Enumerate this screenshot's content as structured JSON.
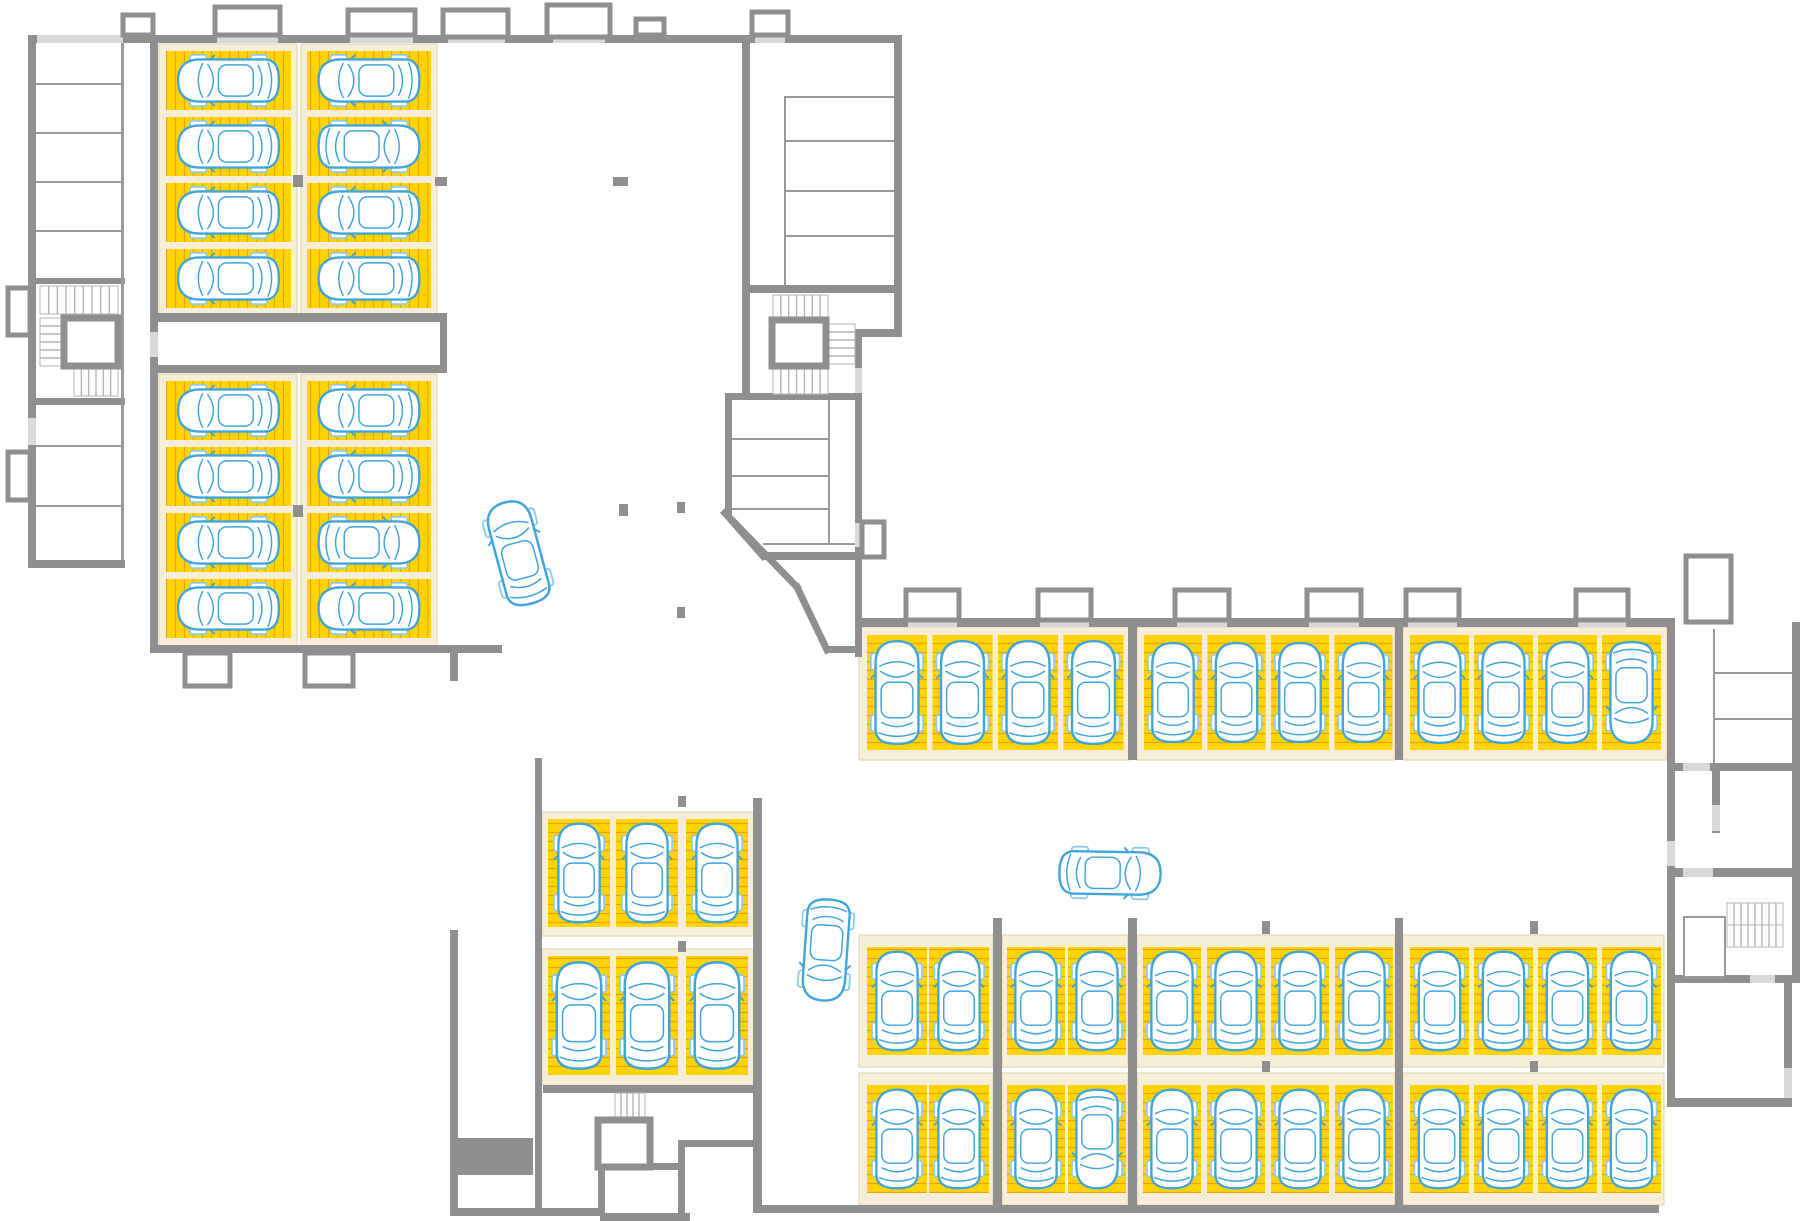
{
  "canvas": {
    "width": 1800,
    "height": 1221
  },
  "drawing": {
    "type": "parking-garage-floor-plan",
    "visible_text": [],
    "summary": {
      "parking_stalls": 58,
      "parked_cars": 58,
      "moving_cars": 3,
      "stair_cores": 4,
      "elevators": 3
    }
  },
  "palette": {
    "background": "#FFFFFF",
    "stall_yellow": "#FFD400",
    "stall_hatch": "#EFA200",
    "stall_apron_cream": "#F6EED8",
    "apron_outline": "#DDD3AF",
    "wall_gray": "#8F8F8F",
    "wall_light_door": "#D9D9D9",
    "thin_line_gray": "#9A9A9A",
    "stair_line_gray": "#B5B5B5",
    "car_outline_blue": "#3FA5DC",
    "car_wheel_blue": "#8FCBEA"
  },
  "stall_blocks": [
    {
      "name": "block-a-col-1",
      "cream": [
        159,
        44,
        138,
        272
      ],
      "orient": "h",
      "x0": 166,
      "y0": 51,
      "dx": 0,
      "dy": 66,
      "w": 125,
      "h": 59,
      "n": 4,
      "flips": []
    },
    {
      "name": "block-a-col-2",
      "cream": [
        301,
        44,
        136,
        272
      ],
      "orient": "h",
      "x0": 307,
      "y0": 51,
      "dx": 0,
      "dy": 66,
      "w": 124,
      "h": 59,
      "n": 4,
      "flips": [
        1
      ]
    },
    {
      "name": "block-b-col-1",
      "cream": [
        159,
        374,
        138,
        273
      ],
      "orient": "h",
      "x0": 166,
      "y0": 381,
      "dx": 0,
      "dy": 66,
      "w": 125,
      "h": 59,
      "n": 4,
      "flips": []
    },
    {
      "name": "block-b-col-2",
      "cream": [
        301,
        374,
        136,
        273
      ],
      "orient": "h",
      "x0": 307,
      "y0": 381,
      "dx": 0,
      "dy": 66,
      "w": 124,
      "h": 59,
      "n": 4,
      "flips": [
        2
      ]
    },
    {
      "name": "center-block-row-1",
      "cream": [
        542,
        812,
        214,
        124
      ],
      "orient": "v",
      "xs": [
        548,
        616,
        686
      ],
      "y0": 819,
      "w": 62,
      "h": 108,
      "n": 3,
      "flips": []
    },
    {
      "name": "center-block-row-2",
      "cream": [
        542,
        949,
        214,
        136
      ],
      "orient": "v",
      "xs": [
        548,
        616,
        686
      ],
      "y0": 956,
      "w": 62,
      "h": 119,
      "n": 3,
      "flips": []
    },
    {
      "name": "north-east-row-group-1",
      "cream": [
        859,
        627,
        271,
        133
      ],
      "orient": "v",
      "x0": 867,
      "y0": 635,
      "dx": 65.5,
      "dy": 0,
      "w": 60,
      "h": 115,
      "n": 4,
      "flips": []
    },
    {
      "name": "north-east-row-group-2",
      "cream": [
        1137,
        627,
        258,
        133
      ],
      "orient": "v",
      "x0": 1144,
      "y0": 635,
      "dx": 63.5,
      "dy": 0,
      "w": 58,
      "h": 115,
      "n": 4,
      "flips": []
    },
    {
      "name": "north-east-row-group-3",
      "cream": [
        1403,
        627,
        264,
        133
      ],
      "orient": "v",
      "x0": 1410,
      "y0": 635,
      "dx": 64,
      "dy": 0,
      "w": 59,
      "h": 115,
      "n": 4,
      "flips": [
        3
      ]
    },
    {
      "name": "south-row-a-group-1",
      "cream": [
        859,
        935,
        134,
        132
      ],
      "orient": "v",
      "x0": 867,
      "y0": 947,
      "dx": 62,
      "dy": 0,
      "w": 60,
      "h": 108,
      "n": 2,
      "flips": []
    },
    {
      "name": "south-row-a-group-2",
      "cream": [
        1002,
        935,
        126,
        132
      ],
      "orient": "v",
      "x0": 1007,
      "y0": 947,
      "dx": 61,
      "dy": 0,
      "w": 58,
      "h": 108,
      "n": 2,
      "flips": []
    },
    {
      "name": "south-row-a-group-3",
      "cream": [
        1137,
        935,
        258,
        132
      ],
      "orient": "v",
      "x0": 1143,
      "y0": 947,
      "dx": 64,
      "dy": 0,
      "w": 58,
      "h": 108,
      "n": 4,
      "flips": []
    },
    {
      "name": "south-row-a-group-4",
      "cream": [
        1403,
        935,
        261,
        132
      ],
      "orient": "v",
      "x0": 1410,
      "y0": 947,
      "dx": 64,
      "dy": 0,
      "w": 59,
      "h": 108,
      "n": 4,
      "flips": []
    },
    {
      "name": "south-row-b-group-1",
      "cream": [
        859,
        1073,
        134,
        132
      ],
      "orient": "v",
      "x0": 867,
      "y0": 1085,
      "dx": 62,
      "dy": 0,
      "w": 60,
      "h": 108,
      "n": 2,
      "flips": []
    },
    {
      "name": "south-row-b-group-2",
      "cream": [
        1002,
        1073,
        126,
        132
      ],
      "orient": "v",
      "x0": 1007,
      "y0": 1085,
      "dx": 61,
      "dy": 0,
      "w": 58,
      "h": 108,
      "n": 2,
      "flips": [
        1
      ]
    },
    {
      "name": "south-row-b-group-3",
      "cream": [
        1137,
        1073,
        258,
        132
      ],
      "orient": "v",
      "x0": 1143,
      "y0": 1085,
      "dx": 64,
      "dy": 0,
      "w": 58,
      "h": 108,
      "n": 4,
      "flips": []
    },
    {
      "name": "south-row-b-group-4",
      "cream": [
        1403,
        1073,
        261,
        132
      ],
      "orient": "v",
      "x0": 1410,
      "y0": 1085,
      "dx": 64,
      "dy": 0,
      "w": 59,
      "h": 108,
      "n": 4,
      "flips": []
    }
  ],
  "walls": [
    [
      28,
      35,
      874,
      8
    ],
    [
      28,
      35,
      8,
      533
    ],
    [
      28,
      560,
      97,
      8
    ],
    [
      28,
      278,
      97,
      6
    ],
    [
      28,
      398,
      97,
      7
    ],
    [
      150,
      43,
      8,
      602
    ],
    [
      158,
      313,
      289,
      9
    ],
    [
      158,
      365,
      289,
      8
    ],
    [
      440,
      313,
      7,
      60
    ],
    [
      150,
      645,
      352,
      8
    ],
    [
      450,
      653,
      8,
      28
    ],
    [
      450,
      930,
      8,
      286
    ],
    [
      455,
      1138,
      78,
      37
    ],
    [
      450,
      1208,
      93,
      8
    ],
    [
      543,
      1208,
      58,
      8
    ],
    [
      600,
      1213,
      90,
      8
    ],
    [
      535,
      758,
      7,
      455
    ],
    [
      543,
      1085,
      219,
      8
    ],
    [
      753,
      798,
      9,
      415
    ],
    [
      753,
      1205,
      906,
      8
    ],
    [
      742,
      43,
      8,
      352
    ],
    [
      725,
      393,
      7,
      122
    ],
    [
      725,
      393,
      135,
      7
    ],
    [
      894,
      43,
      8,
      294
    ],
    [
      855,
      329,
      47,
      8
    ],
    [
      855,
      337,
      7,
      320
    ],
    [
      827,
      646,
      30,
      7
    ],
    [
      763,
      552,
      94,
      8
    ],
    [
      855,
      618,
      820,
      9
    ],
    [
      1667,
      622,
      8,
      485
    ],
    [
      1675,
      763,
      125,
      8
    ],
    [
      1712,
      771,
      8,
      62
    ],
    [
      1675,
      868,
      117,
      9
    ],
    [
      1675,
      975,
      117,
      8
    ],
    [
      1784,
      983,
      8,
      124
    ],
    [
      1792,
      622,
      8,
      361
    ],
    [
      1675,
      1098,
      117,
      9
    ],
    [
      993,
      918,
      9,
      295
    ],
    [
      1128,
      918,
      9,
      295
    ],
    [
      1395,
      918,
      8,
      295
    ],
    [
      1128,
      627,
      9,
      133
    ],
    [
      1395,
      627,
      8,
      133
    ],
    [
      598,
      1167,
      7,
      47
    ],
    [
      650,
      1163,
      35,
      7
    ],
    [
      678,
      1140,
      7,
      75
    ],
    [
      685,
      1140,
      77,
      7
    ],
    [
      750,
      285,
      152,
      8
    ]
  ],
  "diagonal_walls": [
    [
      725,
      513,
      763,
      556
    ],
    [
      725,
      513,
      797,
      587
    ],
    [
      797,
      587,
      827,
      650
    ]
  ],
  "thin_lines": [
    [
      121,
      43,
      3,
      517
    ],
    [
      36,
      83,
      85,
      2
    ],
    [
      36,
      132,
      85,
      2
    ],
    [
      36,
      181,
      85,
      2
    ],
    [
      36,
      230,
      85,
      2
    ],
    [
      36,
      445,
      85,
      2
    ],
    [
      36,
      505,
      85,
      2
    ],
    [
      784,
      96,
      2,
      190
    ],
    [
      786,
      96,
      108,
      2
    ],
    [
      786,
      140,
      108,
      2
    ],
    [
      786,
      190,
      108,
      2
    ],
    [
      786,
      235,
      108,
      2
    ],
    [
      732,
      438,
      96,
      2
    ],
    [
      732,
      475,
      96,
      2
    ],
    [
      732,
      508,
      96,
      2
    ],
    [
      828,
      400,
      2,
      145
    ],
    [
      763,
      543,
      94,
      2
    ],
    [
      1713,
      629,
      2,
      134
    ],
    [
      1715,
      672,
      77,
      2
    ],
    [
      1715,
      718,
      77,
      2
    ]
  ],
  "outline_rooms": [
    [
      1684,
      917,
      41,
      60
    ]
  ],
  "light_doors": [
    [
      37,
      35,
      86,
      8
    ],
    [
      217,
      35,
      61,
      8
    ],
    [
      350,
      35,
      63,
      8
    ],
    [
      448,
      36,
      57,
      7
    ],
    [
      553,
      36,
      52,
      7
    ],
    [
      755,
      36,
      30,
      7
    ],
    [
      28,
      418,
      8,
      27
    ],
    [
      150,
      332,
      8,
      25
    ],
    [
      855,
      368,
      7,
      25
    ],
    [
      855,
      523,
      7,
      24
    ],
    [
      908,
      618,
      49,
      9
    ],
    [
      1040,
      618,
      49,
      9
    ],
    [
      1177,
      618,
      50,
      9
    ],
    [
      1309,
      618,
      50,
      9
    ],
    [
      1408,
      618,
      49,
      9
    ],
    [
      1578,
      618,
      48,
      9
    ],
    [
      1667,
      841,
      8,
      25
    ],
    [
      1683,
      763,
      27,
      8
    ],
    [
      1712,
      805,
      8,
      26
    ],
    [
      1683,
      868,
      30,
      9
    ],
    [
      1750,
      975,
      25,
      8
    ],
    [
      1784,
      1068,
      8,
      30
    ],
    [
      1690,
      604,
      37,
      17
    ]
  ],
  "wall_niches": [
    [
      123,
      15,
      30,
      20
    ],
    [
      215,
      7,
      65,
      28
    ],
    [
      348,
      10,
      67,
      25
    ],
    [
      443,
      10,
      65,
      27
    ],
    [
      547,
      5,
      63,
      32
    ],
    [
      636,
      19,
      28,
      16
    ],
    [
      752,
      12,
      36,
      23
    ],
    [
      906,
      590,
      53,
      30
    ],
    [
      1038,
      590,
      53,
      30
    ],
    [
      1175,
      590,
      54,
      30
    ],
    [
      1307,
      590,
      54,
      30
    ],
    [
      1406,
      590,
      53,
      30
    ],
    [
      1576,
      590,
      52,
      30
    ],
    [
      8,
      288,
      22,
      47
    ],
    [
      8,
      452,
      22,
      48
    ],
    [
      185,
      653,
      45,
      33
    ],
    [
      305,
      653,
      48,
      33
    ],
    [
      1686,
      556,
      45,
      66
    ],
    [
      862,
      522,
      22,
      35
    ]
  ],
  "pillars": [
    [
      293,
      175,
      10,
      12
    ],
    [
      293,
      505,
      10,
      12
    ],
    [
      435,
      177,
      12,
      9
    ],
    [
      613,
      177,
      15,
      9
    ],
    [
      619,
      504,
      9,
      12
    ],
    [
      677,
      502,
      8,
      11
    ],
    [
      677,
      607,
      8,
      11
    ],
    [
      678,
      796,
      8,
      11
    ],
    [
      678,
      941,
      8,
      11
    ],
    [
      1262,
      921,
      8,
      13
    ],
    [
      1530,
      921,
      8,
      13
    ],
    [
      1262,
      1061,
      8,
      11
    ],
    [
      1530,
      1061,
      8,
      11
    ]
  ],
  "stairs": [
    [
      40,
      286,
      78,
      28,
      "v",
      9
    ],
    [
      40,
      318,
      24,
      48,
      "h",
      6
    ],
    [
      74,
      368,
      44,
      28,
      "v",
      6
    ],
    [
      773,
      295,
      55,
      23,
      "v",
      7
    ],
    [
      828,
      324,
      27,
      40,
      "h",
      5
    ],
    [
      773,
      368,
      55,
      26,
      "v",
      7
    ],
    [
      1727,
      903,
      56,
      22,
      "v",
      8
    ],
    [
      1727,
      925,
      56,
      22,
      "v",
      8
    ],
    [
      615,
      1093,
      30,
      27,
      "v",
      5
    ]
  ],
  "elevators": [
    [
      64,
      318,
      54,
      48
    ],
    [
      772,
      320,
      54,
      46
    ],
    [
      598,
      1120,
      52,
      47
    ]
  ],
  "moving_cars": [
    {
      "cx": 518,
      "cy": 553,
      "rot": -15,
      "s": 0.95
    },
    {
      "cx": 826,
      "cy": 950,
      "rot": 184,
      "s": 0.92
    },
    {
      "cx": 1110,
      "cy": 873,
      "rot": 91,
      "s": 0.92
    }
  ]
}
